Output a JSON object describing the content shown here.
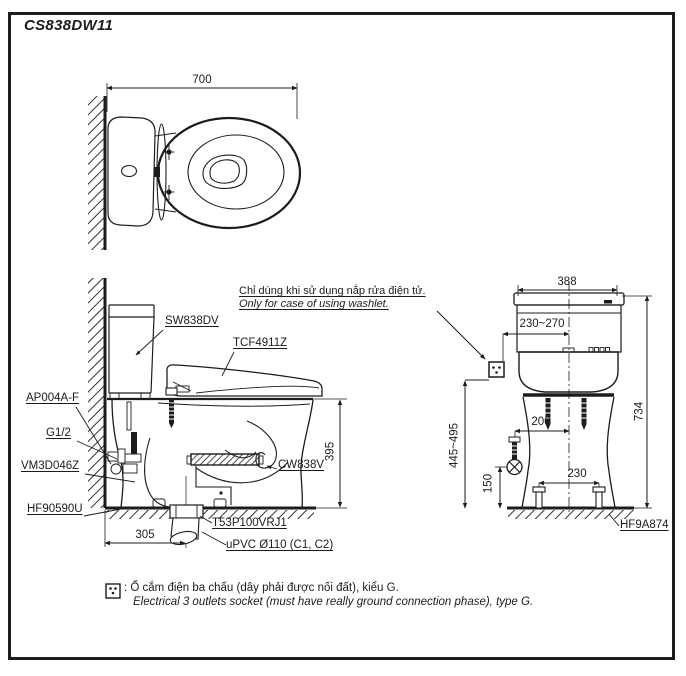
{
  "title": "CS838DW11",
  "colors": {
    "ink": "#1c1c1c",
    "paper": "#ffffff"
  },
  "top_view": {
    "dim_width": "700"
  },
  "side_view": {
    "label_tank": "SW838DV",
    "label_washlet": "TCF4911Z",
    "label_supply_hose": "AP004A-F",
    "label_thread": "G1/2",
    "label_stop_valve": "VM3D046Z",
    "label_wax_ring": "HF90590U",
    "label_bowl": "CW838V",
    "label_drain_joint": "T53P100VRJ1",
    "label_drain_pipe": "uPVC Ø110 (C1, C2)",
    "dim_rim_height": "395",
    "dim_drain_offset": "305"
  },
  "front_view": {
    "dim_width": "388",
    "dim_socket_offset": "230~270",
    "dim_total_height": "734",
    "dim_socket_height": "445~495",
    "dim_supply_offset": "200",
    "dim_supply_height": "150",
    "dim_bolt_spacing": "230",
    "label_bolt_cap": "HF9A874"
  },
  "washlet_note": {
    "vi": "Chỉ dùng khi sử dụng nắp rửa điện tử.",
    "en": "Only for case of using washlet."
  },
  "legend": {
    "vi": ": Ổ cắm điện ba chấu (dây phải được nối đất), kiểu G.",
    "en": "Electrical 3 outlets socket (must have really ground connection phase), type G."
  }
}
